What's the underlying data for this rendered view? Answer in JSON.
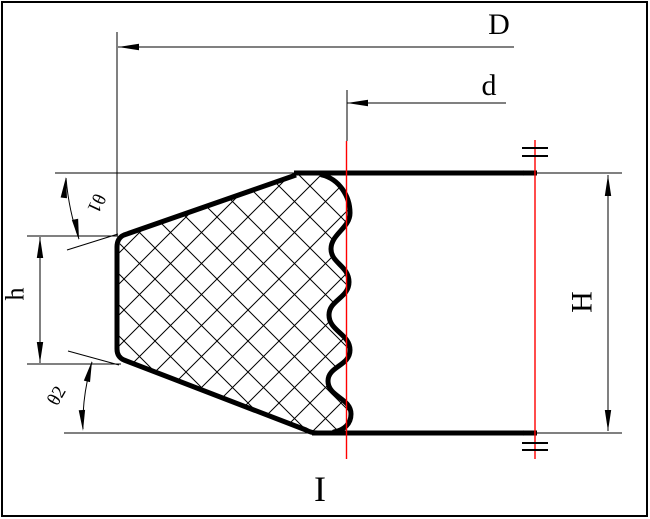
{
  "drawing": {
    "labels": {
      "outer_diameter": "D",
      "inner_diameter": "d",
      "overall_height": "H",
      "lip_height": "h",
      "top_angle": "θ1",
      "bottom_angle": "θ2",
      "section_mark": "I"
    },
    "colors": {
      "line": "#000000",
      "centerline": "#ff0000",
      "background": "#ffffff"
    }
  }
}
